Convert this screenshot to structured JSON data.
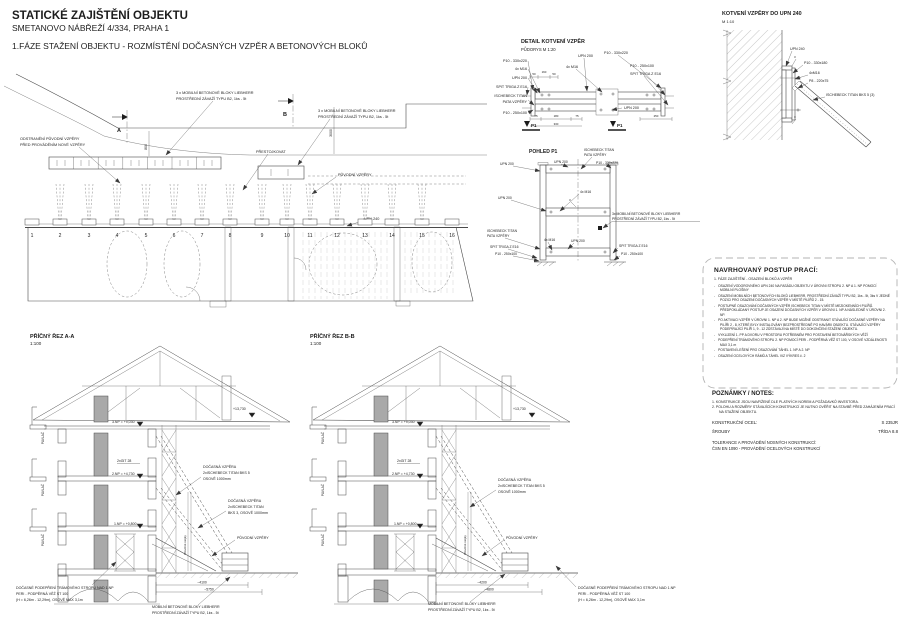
{
  "titles": {
    "main": "STATICKÉ ZAJIŠTĚNÍ OBJEKTU",
    "address": "SMETANOVO NÁBŘEŽÍ 4/334, PRAHA 1",
    "phase": "1.FÁZE STAŽENÍ OBJEKTU - ROZMÍSTĚNÍ DOČASNÝCH VZPĚR A BETONOVÝCH BLOKŮ"
  },
  "plan": {
    "remove_line1": "ODSTRANĚNÍ PŮVODNÍ VZPĚRY",
    "remove_line2": "PŘED PROVÁDĚNÍM NOVÉ VZPĚRY",
    "blocks_top_line1": "3 x MOBILNÍ BETONOVÉ BLOKY LIEBHERR",
    "blocks_top_line2": "PROSTŘEDNÍ ZÁVAŽÍ TYPU B2, 1ks - 5t",
    "blocks_mid_line1": "3 x MOBILNÍ BETONOVÉ BLOKY LIEBHERR",
    "blocks_mid_line2": "PROSTŘEDNÍ ZÁVAŽÍ TYPU B2, 1ks - 5t",
    "prestojkovat": "PŘESTOJKOVAT",
    "puvodni_vzpery": "PŮVODNÍ VZPĚRY",
    "upn240": "UPN 240",
    "dim_800": "800",
    "dim_3000": "3000",
    "marker_a": "A",
    "marker_b": "B",
    "grid": [
      "1",
      "2",
      "3",
      "4",
      "5",
      "6",
      "7",
      "8",
      "9",
      "10",
      "11",
      "12",
      "13",
      "14",
      "15",
      "16"
    ]
  },
  "detail": {
    "title": "DETAIL KOTVENÍ VZPĚR",
    "subtitle": "PŮDORYS  M 1:20",
    "lbl_p10_330x220": "P10 - 330x220",
    "lbl_4xm16": "4x M16",
    "lbl_upn200": "UPN 200",
    "lbl_spit": "SPIT TRIGA Z E16",
    "lbl_ischebeck1": "ISCHEBECK TITAN",
    "lbl_ischebeck2": "PATA VZPĚRY",
    "lbl_p10_250x100": "P10 - 250x100",
    "top_upn200": "UPN 200",
    "top_p10": "P10 - 330x220",
    "right_p10": "P10 - 250x100",
    "right_spit": "SPIT TRIGA Z E16",
    "right_upn200": "UPN 200",
    "mid_4xm16": "4x M16",
    "p1": "P1",
    "dims": {
      "d50a": "50",
      "d160": "160",
      "d50b": "50",
      "d75a": "75",
      "d180": "180",
      "d75b": "75",
      "d330": "330",
      "d250": "250"
    }
  },
  "pohled": {
    "title": "POHLED P1",
    "top_ischebeck1": "ISCHEBECK TITAN",
    "top_ischebeck2": "PATA VZPĚRY",
    "top_upn200": "UPN 200",
    "top_p10": "P10 - 330x220",
    "left_upn200": "UPN 200",
    "left_upn200_2": "UPN 200",
    "mid_4xm16": "4x M16",
    "left_ischebeck1": "ISCHEBECK TITAN",
    "left_ischebeck2": "PATA VZPĚRY",
    "left_4xm16": "4x M16",
    "left_spit": "SPIT TRIGA Z E16",
    "left_p10": "P10 - 250x100",
    "mid_upn200": "UPN 200",
    "right_blocks1": "3x MOBILNÍ BETONOVÉ BLOKY LIEBHERR",
    "right_blocks2": "PROSTŘEDNÍ ZÁVAŽÍ TYPU B2, 1ks - 5t",
    "right_spit": "SPIT TRIGA Z E16",
    "right_p10": "P10 - 250x100",
    "weld3": "3"
  },
  "kotveni": {
    "title": "KOTVENÍ VZPĚRY DO UPN 240",
    "scale": "M 1:10",
    "upn240": "UPN 240",
    "p10": "P10 - 330x180",
    "m16": "4xM16",
    "p8": "P8 - 220x75",
    "ischebeck": "ISCHEBECK TITAN BKS 5 (3)",
    "weld3a": "3",
    "weld3b": "3"
  },
  "postup": {
    "title": "NAVRHOVANÝ POSTUP PRACÍ:",
    "intro": "1. FÁZE ZAJIŠTĚNÍ - OSAZENÍ BLOKŮ A VZPĚR",
    "items": [
      "OSAZENÍ VODOROVNÉHO UPN 240 NA FASÁDU OBJEKTU V ÚROVNI STROPU 2. NP A 1. NP POMOCÍ MOBILNÍ PLOŠINY",
      "OSAZENÍ MOBILNÍCH BETONOVÝCH BLOKŮ LIEBHERR, PROSTŘEDNÍ ZÁVAŽÍ TYPU B2, 1ks - 5t, 3ks V JEDNÉ POZICI PRO OSAZENÍ DOČASNÝCH VZPĚR V MÍSTĚ PILÍŘŮ 2 - 15.",
      "POSTUPNÉ OSAZOVÁNÍ DOČASNÝCH VZPĚR ISCHEBECK TITAN V MÍSTĚ MEZIOKENNÍCH PILÍŘŮ. PŘEDPOKLÁDANÝ POSTUP JE OSAZENÍ DOČASNÝCH VZPĚR V ÚROVNI 1. NP A NÁSLEDNĚ V ÚROVNI 2. NP.",
      "PO AKTIVACI VZPĚR V ÚROVNI 1. NP A 2. NP BUDE MOŽNÉ ODSTRANIT STÁVAJÍCÍ DOČASNÉ VZPĚRY NA PILÍŘI 2 - 8, KTERÉ BYLY INSTALOVÁNY BEZPROSTŘEDNĚ PO HAVÁRII OBJEKTU. STÁVAJÍCÍ VZPĚRY PODEPÍRAJÍCÍ PILÍŘ 1, 9 - 12 ZŮSTÁVAJÍ NA MÍSTĚ DO DOKONČENÍ STAŽENÍ OBJEKTU.",
      "VYKLIZENÍ 1. PP A DVORU V PROSTORU POTŘEBNÉM PRO POSTAVENÍ BETONÁŘSKÝCH VĚŽÍ",
      "PODEPŘENÍ TRÁMOVÉHO STROPU 2. NP POMOCÍ PERI - PODPĚRNÁ VĚŽ ST 100, V OSOVÉ VZDÁLENOSTI MAX 3,1 m",
      "POSTAVENÍ LEŠENÍ PRO OSAZOVÁNÍ TÁHEL 1. NP A 2. NP",
      "OSAZENÍ OCELOVÝCH RÁMŮ A TÁHEL VIZ VÝKRES č. 2"
    ]
  },
  "poznamky": {
    "title": "POZNÁMKY / NOTES:",
    "n1": "1.   KONSTRUKCE JSOU NAVRŽENÉ DLE PLATNÝCH NOREM A POŽADAVKŮ INVESTORA.",
    "n2": "2.   POLOHU A ROZMĚRY STÁVAJÍCÍCH KONSTRUKCÍ JE NUTNO OVĚŘIT NA STAVBĚ PŘED ZAHÁJENÍM PRACÍ NA STAŽENÍ OBJEKTU.",
    "steel_label": "KONSTRUKČNÍ OCEL:",
    "steel_value": "S 235JR",
    "bolts_label": "ŠROUBY",
    "bolts_value": "TŘÍDA 8.8",
    "tol1": "TOLERANCE A PROVÁDĚNÍ NOSNÝCH KONSTRUKCÍ:",
    "tol2": "ČSN EN 1090 - PROVÁDĚNÍ OCELOVÝCH KONSTRUKCÍ"
  },
  "section_a": {
    "title": "PŘÍČNÝ ŘEZ A-A",
    "scale": "1:100",
    "lvl_top": "+13,730",
    "lvl_3np": "3.NP = +9,030",
    "lvl_2np": "2.NP = +4,730",
    "lvl_1np": "1.NP = +0,800",
    "git": "2xGIT 28",
    "pavlac1": "PAVLAČ",
    "pavlac2": "PAVLAČ",
    "pavlac3": "PAVLAČ",
    "drevena": "Dřevěné stojky",
    "vzpera1_l1": "DOČASNÁ VZPĚRA",
    "vzpera1_l2": "2xISCHEBECK TITAN BKS 5",
    "vzpera1_l3": "OSOVĚ 1000mm",
    "vzpera2_l1": "DOČASNÁ VZPĚRA",
    "vzpera2_l2": "2xISCHEBECK TITAN",
    "vzpera2_l3": "BKS 3, OSOVĚ 1000mm",
    "puvodni": "PŮVODNÍ VZPĚRY",
    "dim1": "~4100",
    "dim2": "~5750",
    "podepreni_l1": "DOČASNÉ PODEPŘENÍ TRÁMOVÉHO STROPU NAD 1.NP",
    "podepreni_l2": "PERI - PODPĚRNÁ VĚŽ ST 100",
    "podepreni_l3": "(H = 6,26m - 12,29m), OSOVĚ MAX 3,1m",
    "bloky_l1": "MOBILNÍ BETONOVÉ BLOKY LIEBHERR",
    "bloky_l2": "PROSTŘEDNÍ ZÁVAŽÍ TYPU B2, 1ks - 5t"
  },
  "section_b": {
    "title": "PŘÍČNÝ ŘEZ B-B",
    "scale": "1:100",
    "lvl_top": "+13,730",
    "lvl_3np": "3.NP = +9,030",
    "lvl_2np": "2.NP = +4,730",
    "lvl_1np": "1.NP = +0,800",
    "git": "2xGIT 28",
    "pavlac1": "PAVLAČ",
    "pavlac2": "PAVLAČ",
    "pavlac3": "PAVLAČ",
    "drevena": "Dřevěné stojky",
    "vzpera1_l1": "DOČASNÁ VZPĚRA",
    "vzpera1_l2": "2xISCHEBECK TITAN BKS 5",
    "vzpera1_l3": "OSOVĚ 1000mm",
    "puvodni": "PŮVODNÍ VZPĚRY",
    "dim1": "~4200",
    "dim2": "~4800",
    "bloky_l1": "MOBILNÍ BETONOVÉ BLOKY LIEBHERR",
    "bloky_l2": "PROSTŘEDNÍ ZÁVAŽÍ TYPU B2, 1ks - 5t",
    "podepreni_l1": "DOČASNÉ PODEPŘENÍ TRÁMOVÉHO STROPU NAD 1.NP",
    "podepreni_l2": "PERI - PODPĚRNÁ VĚŽ ST 100",
    "podepreni_l3": "(H = 6,26m - 12,29m), OSOVĚ MAX 3,1m"
  }
}
